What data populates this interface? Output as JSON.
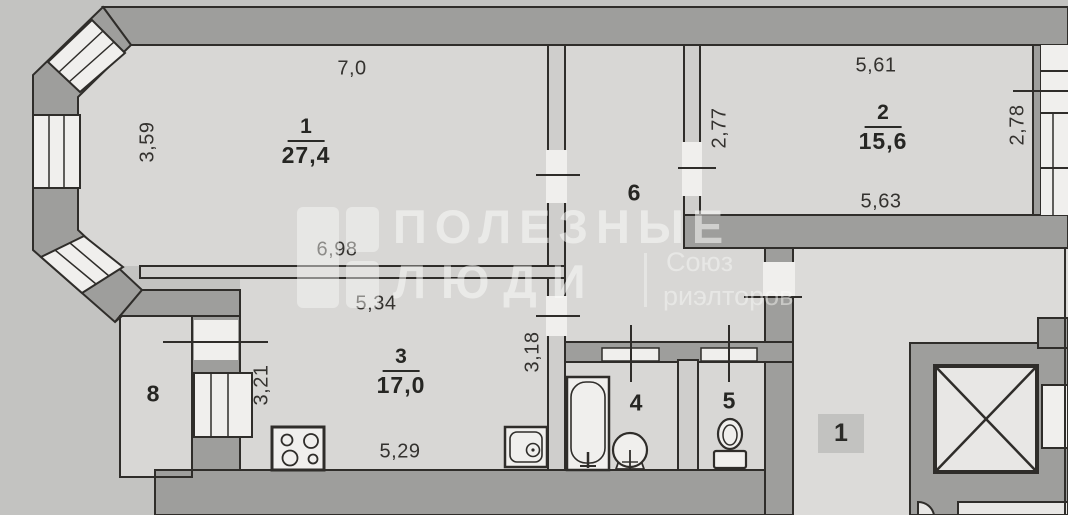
{
  "plan_type": "apartment-floor-plan",
  "rooms": {
    "r1": {
      "number": "1",
      "area": "27,4"
    },
    "r2": {
      "number": "2",
      "area": "15,6"
    },
    "r3": {
      "number": "3",
      "area": "17,0"
    },
    "r4": {
      "number": "4"
    },
    "r5": {
      "number": "5"
    },
    "r6": {
      "number": "6"
    },
    "r8": {
      "number": "8"
    },
    "landing": {
      "number": "1"
    }
  },
  "dimensions": {
    "room1_top": "7,0",
    "room1_left": "3,59",
    "room1_bottom": "6,98",
    "room2_top": "5,61",
    "room2_left": "2,77",
    "room2_right": "2,78",
    "room2_bottom": "5,63",
    "room3_top": "5,34",
    "room3_left": "3,21",
    "room3_right": "3,18",
    "room3_bottom": "5,29"
  },
  "watermark": {
    "brand_top": "ПОЛЕЗНЫЕ",
    "brand_bottom": "ЛЮДИ",
    "tagline_top": "Союз",
    "tagline_bottom": "риэлторов"
  },
  "icons": [
    "stove-icon",
    "kitchen-sink-icon",
    "bathtub-icon",
    "round-sink-icon",
    "toilet-icon",
    "elevator-shaft-icon",
    "window",
    "door-opening"
  ],
  "colors": {
    "background": "#c3c3c1",
    "floor": "#d8d7d5",
    "wall": "#9e9e9c",
    "line": "#2f2d2a",
    "white": "#f0efed"
  }
}
